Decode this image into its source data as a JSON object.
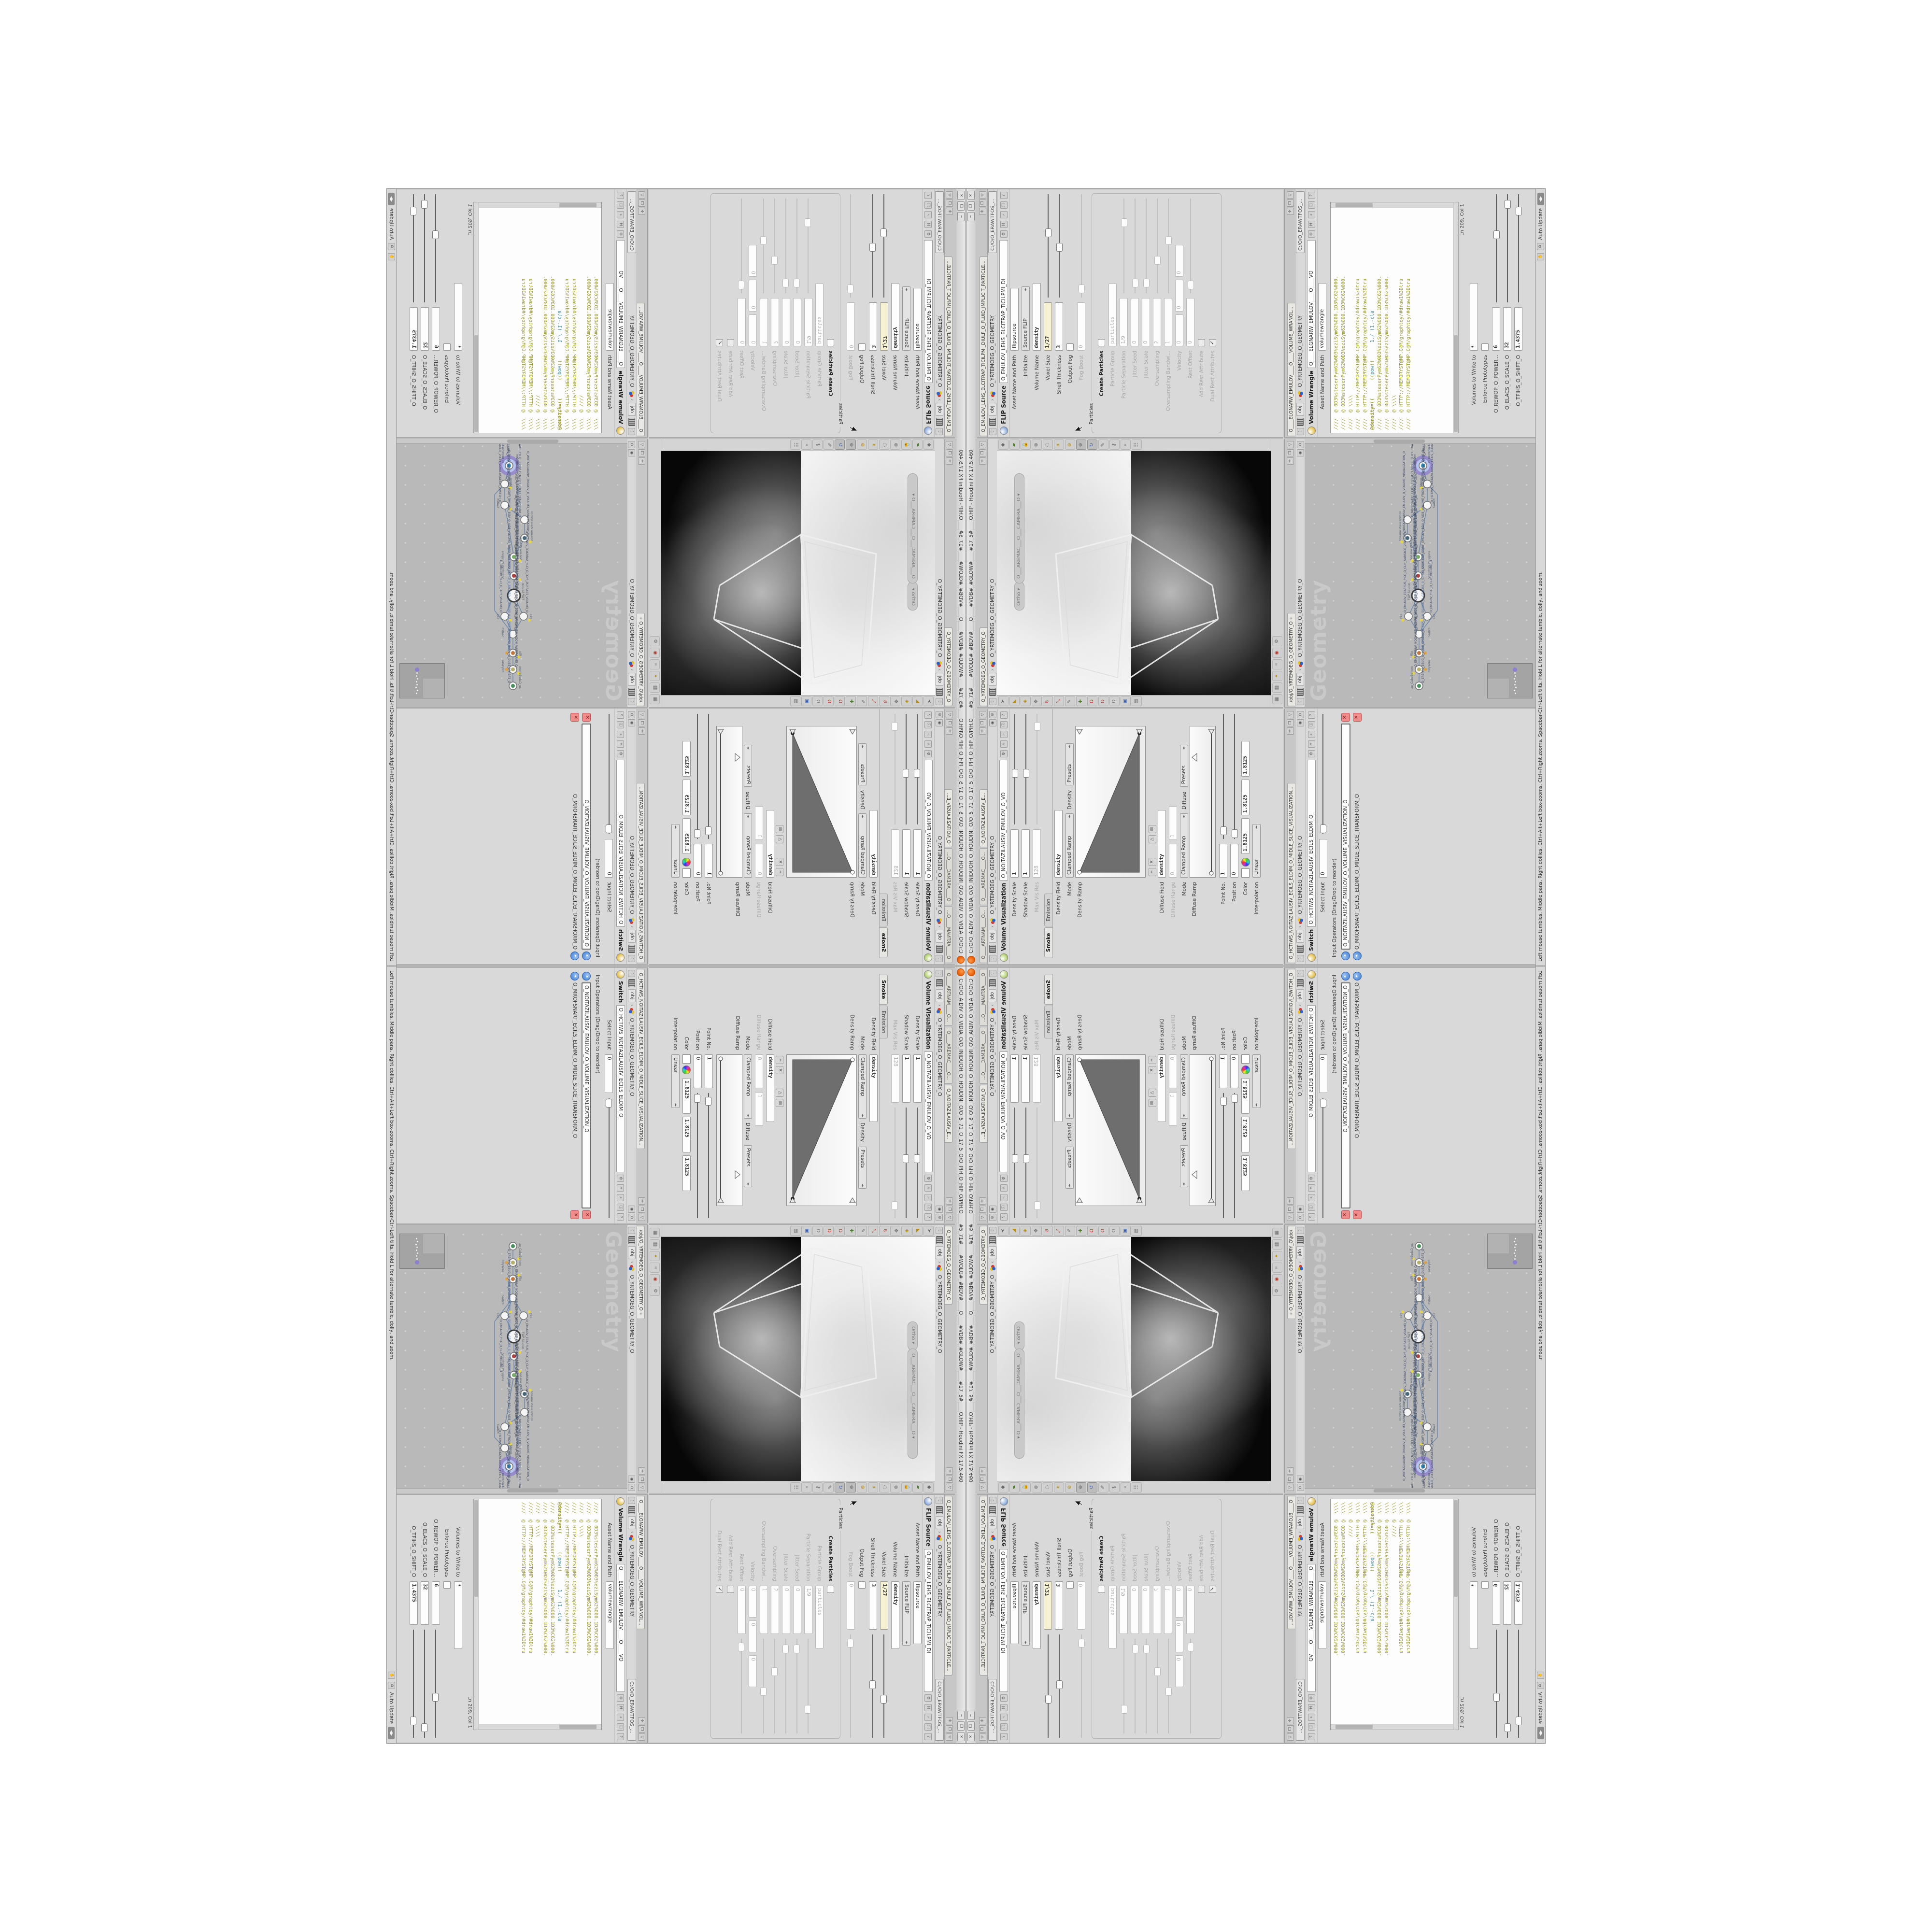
{
  "window": {
    "title": "C:/O/O_AIDIV_O_VIDIA_O/O_INIDUOH_O_HOUDINI_O/O_5_71_O_17_5_O/O_PIH_O_HIP_O/PIH.O____#5_71#____#WOLG#_#BDV#____O____#VDB#_#GLOW#____#17_5#____O.HIP - Houdini FX 17.5.460"
  },
  "icons": {
    "close": "✕",
    "restore": "❐",
    "minimize": "─",
    "split": "✛",
    "maximize": "❒",
    "collapse": "▽",
    "play": "▸",
    "radar": "◉",
    "pin": "⊙",
    "up": "⇧",
    "gear": "⚙",
    "hscript": "H",
    "search": "⌕",
    "info": "ⓘ",
    "help": "?",
    "check": "✓",
    "recycle": "♻",
    "wheel": "◍",
    "add": "+",
    "del": "✕",
    "tri": "△",
    "grid": "⊞",
    "hand": "✋",
    "leftright": "◀▶",
    "camera": "⌘",
    "star": "✳"
  },
  "crumbs": {
    "root": "obj",
    "geometry": "O_YRTEMOEG_O_GEOMETRY_O",
    "sep": "›"
  },
  "vv": {
    "tabs": [
      "O____ARTNAM____O...",
      "O____AREMAC____O...",
      "O_NOITAZILAUSIV_E..."
    ],
    "title": "Volume Visualization",
    "name": "O_NOITAZILAUSIV_EMULOV_O_VO",
    "density_scale": "Density Scale",
    "density_scale_v": "1",
    "shadow_scale": "Shadow Scale",
    "shadow_scale_v": "1",
    "max_vis": "Max Vis Res",
    "max_vis_v": "128",
    "tab_smoke": "Smoke",
    "tab_emission": "Emission",
    "density_field": "Density Field",
    "density_field_v": "density",
    "mode": "Mode",
    "mode_v": "Clamped Ramp",
    "mode_tag": "Density",
    "presets": "Presets",
    "density_ramp": "Density Ramp",
    "diffuse_field": "Diffuse Field",
    "diffuse_field_v": "density",
    "diffuse_range": "Diffuse Range",
    "diffuse_range_v0": "0",
    "diffuse_range_v1": "1",
    "mode2_tag": "Diffuse",
    "diffuse_ramp": "Diffuse Ramp",
    "point_no": "Point No.",
    "point_no_v": "1",
    "position": "Position",
    "position_v": "0",
    "color": "Color",
    "color_v": "1.8125",
    "interp": "Interpolation",
    "interp_v": "Linear"
  },
  "sw": {
    "tab": "O_HCTIWS_NOITAZILAUSIV_ECILS_ELDIM_O_MIDLE_SLICE_VISUALIZATION...",
    "title": "Switch",
    "name": "O_HCTIWS_NOITAZILAUSIV_ECILS_ELDIM_O_",
    "select_input": "Select Input",
    "select_input_v": "0",
    "ops_label": "Input Operators (Drag/Drop to reorder)",
    "ops": [
      "O_NOITAZILAUSIV_EMULOV_O_VOLUME_VISUALIZATION_O",
      "O_MROFSNART_ECILS_ELDIM_O_MIDLE_SLICE_TRANSFORM_O"
    ]
  },
  "vp": {
    "tab": "O_YRTEMOEG_O_GEOMETRY_O",
    "ortho": "Ortho",
    "camera": "O___AREMAC___O___CAMERA___O"
  },
  "net": {
    "tab": "/obj/O_YRTEMOEG_O_GEOMETRY_O",
    "watermark": "Geometry",
    "nodes": [
      {
        "type": "ae_CubeSphere",
        "label": "O_EREHPS_EBUC_O_CUBE_SPHERE_O"
      },
      {
        "type": "PolyWire",
        "label": "O_EMARFERIW_NOGYLOP_EREHPS_EBUC_O_CUBE_SPHERE_POLYGON_WIREFRAME_O"
      },
      {
        "type": "File",
        "label": "JBO.AVB3.PETS.TRP1.S_0_5S/OEG_O_GEM.ISS_0_5.TRP1.STEP.3BVA.OBJ"
      },
      {
        "type": "Switch",
        "label": "O_HCTIWS_YRTEMOEG_LANRETXE_LANRETNI_O_INTERNAL_EXTERNAL_GEOMETRY_SWITCH_O"
      },
      {
        "type": "Clip",
        "label": "O_EMULOV_ECAFRUS_PILC_O_CLIP_SURFACE_VOLUME_O"
      },
      {
        "type": "Clip",
        "label": "O_EMULOV_PILC_O_CLIP_VOLUME_O"
      },
      {
        "type": "FLIP Source",
        "label": "O_EMULOV_LEHS_ELCITRAP_TICILPMI_DIULF_O_FLUID_IMPLICIT_PARTICLE_SHEL_VOLUME_O"
      },
      {
        "type": "VDB from Polygons",
        "label": "O_SNOGILOP_MORF_EMULOV_BDV_O_VDB_VOLUME_FROM_GEOMETRY_POLYGONS_O"
      },
      {
        "type": "Volume Wrangle",
        "label": "O___ELGNARW_EMULOV___O___VOLUME_WRANGLE___O"
      },
      {
        "type": "Volume Visualization",
        "label": "O_NOITAZILAUSIV_EMULOV_O_VOLUME_VISUALIZATION_O"
      },
      {
        "type": "Transform",
        "label": "O_MROFSNART_ECILS_ELDIM_O_MIDLE_SLICE_TRANSFORM_O"
      },
      {
        "type": "Switch",
        "label": "O_HCTIWS_NOITAZILAUSIV_ECILS_ELDIM_O_MIDLE_SLICE_VISUALIZATION_SWITCH_O"
      },
      {
        "type": "Merge",
        "label": "O_ECAFRUS_HTIW_EMULOV_EGREM_O_MERGE_VOLUME_WITH_SURFACE_O"
      },
      {
        "type": "Transform",
        "label": "O_MROFSNART_TLUSER_O_RESULT_TRANSFORM_O"
      }
    ]
  },
  "fs": {
    "tab": "O_EMULOV_LEHS_ELCITRAP_TICILPMI_DIULF_O_FLUID_IMPLICIT_PARTICLE...",
    "title": "FLIP Source",
    "name": "O_EMULOV_LEHS_ELCITRAP_TICILPMI_DI",
    "combo": "C:/O/O_ERAWTFOS_...",
    "asset": "Asset Name and Path",
    "asset_v": "flipsource",
    "initialize": "Initialize",
    "initialize_v": "Source FLIP",
    "volume_name": "Volume Name",
    "volume_name_v": "density",
    "voxel_size": "Voxel Size",
    "voxel_size_v": "1/27",
    "shell": "Shell Thickness",
    "shell_v": "3",
    "output_fog": "Output Fog",
    "fog_boost": "Fog Boost",
    "fog_boost_v": "0",
    "particles": "Particles",
    "create_particles": "Create Particles",
    "particle_group": "Particle Group",
    "particle_group_v": "particles",
    "particle_sep": "Particle Separation",
    "particle_sep_v": "1/9",
    "jitter_seed": "Jitter Seed",
    "jitter_seed_v": "0",
    "jitter_scale": "Jitter Scale",
    "jitter_scale_v": "0",
    "oversampling": "Oversampling",
    "oversampling_v": "2",
    "oversampling_bw": "Oversampling Bandwi...",
    "oversampling_bw_v": "1",
    "velocity": "Velocity",
    "velocity_v": "0",
    "rest_offset": "Rest Offset",
    "rest_offset_v": "0",
    "add_rest": "Add Rest Attribute",
    "dual_rest": "Dual Rest Attributes"
  },
  "wr": {
    "tab": "O____ELGNARW_EMULOV____O____VOLUME_WRANGL...",
    "title": "Volume Wrangle",
    "name": "O____ELGNARW_EMULOV____O____VO",
    "combo": "C:/O/O_ERAWTFOS_...",
    "asset": "Asset Name and Path",
    "asset_v": "volumewrangle",
    "code": [
      "////  @ 0D3%steserPym62%0D3%eziSym62%000.1D3%C62%000.",
      "////  @ 0D3%steserPym62%0D3%eziSym62%000.1D3%C62%000.",
      "////  @ \\\\\\\\",
      "////  @ HTTP://MEMORYST@MP.C@M/graphtoy/#draw1%3Dtru",
      "////  @ HTTP://MEMORYST@MP.C@M/graphtoy/#draw1%3Dtru",
      "",
      "",
      "////  @ 0D3%steserPym62%0D3%eziSym62%000.1D3%C62%000.",
      "////  @ 0D3%steserPym62%0D3%eziSym62%000.1D3%C62%000.",
      "////  @ \\\\\\\\",
      "////  @ HTTP://MEMORYST@MP.C@M/graphtoy/#draw1%3Dtru",
      "////  @ HTTP://MEMORYST@MP.C@M/graphtoy/#draw1%3Dtru"
    ],
    "l7a": "@density=((",
    "l7b": "((pow((",
    "l7c": "1./ (1.-cla",
    "ln": "Ln 209, Col 1",
    "volumes": "Volumes to Write to",
    "volumes_v": "*",
    "enforce": "Enforce Prototypes",
    "p_power": "O_REWOP_O_POWER...",
    "p_power_v": "6",
    "p_scale": "O_ELACS_O_SCALE_O",
    "p_scale_v": "32",
    "p_shift": "O_TFIHS_O_SHIFT_O",
    "p_shift_v": "1.4375"
  },
  "status": {
    "help": "Left mouse tumbles. Middle pans. Right dollies. Ctrl+Alt+Left box-zooms. Ctrl+Right zooms. Spacebar-Ctrl-Left tilts. Hold L for alternate tumble, dolly, and zoom.",
    "auto_update": "Auto Update"
  }
}
